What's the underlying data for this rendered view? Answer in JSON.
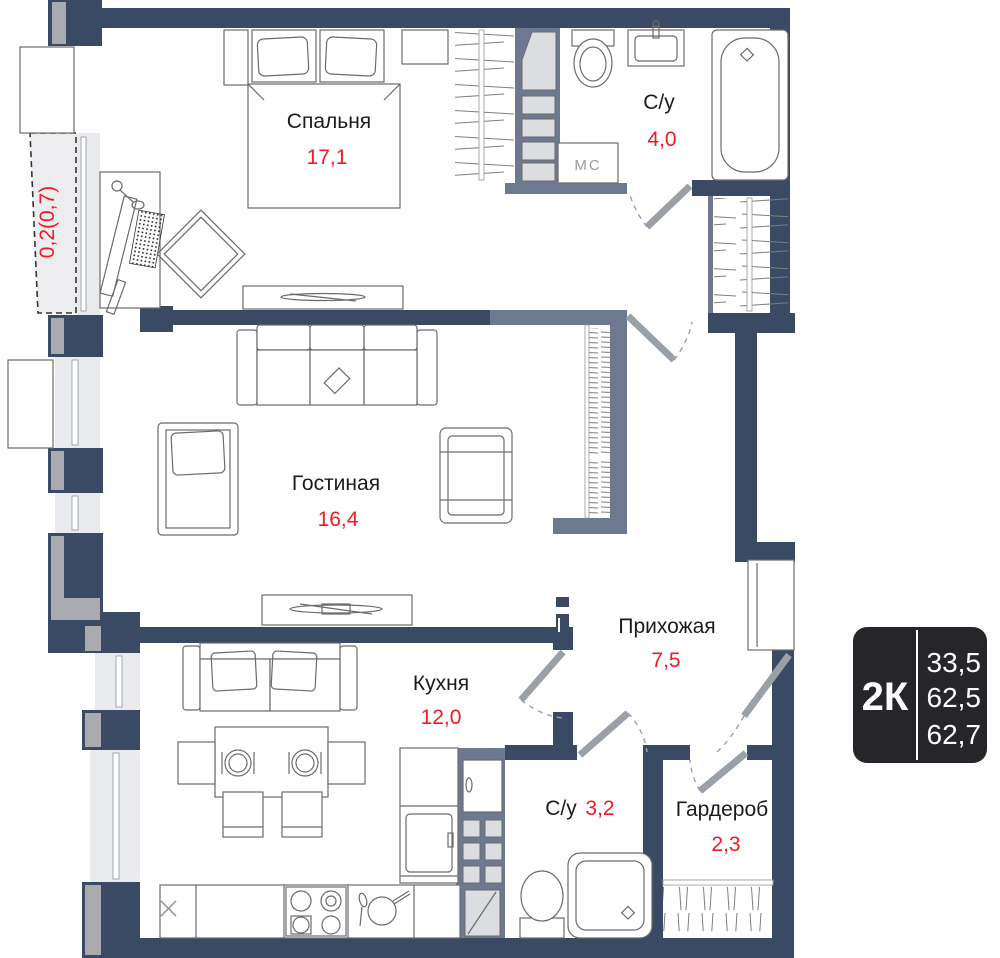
{
  "plan": {
    "rooms": {
      "bedroom": {
        "label": "Спальня",
        "area": "17,1"
      },
      "living": {
        "label": "Гостиная",
        "area": "16,4"
      },
      "kitchen": {
        "label": "Кухня",
        "area": "12,0"
      },
      "hallway": {
        "label": "Прихожая",
        "area": "7,5"
      },
      "bath_main": {
        "label": "С/у",
        "area": "4,0"
      },
      "bath_small": {
        "label": "С/у",
        "area": "3,2"
      },
      "wardrobe": {
        "label": "Гардероб",
        "area": "2,3"
      },
      "balcony": {
        "area": "0,2(0,7)"
      }
    },
    "annotations": {
      "washing_machine": "МС",
      "sink_mark": "X"
    },
    "badge": {
      "type": "2К",
      "values": [
        "33,5",
        "62,5",
        "62,7"
      ]
    },
    "colors": {
      "wall": "#3b4a64",
      "partition": "#6d7990",
      "area_red": "#ec1c24",
      "badge_bg": "#26262a"
    }
  }
}
